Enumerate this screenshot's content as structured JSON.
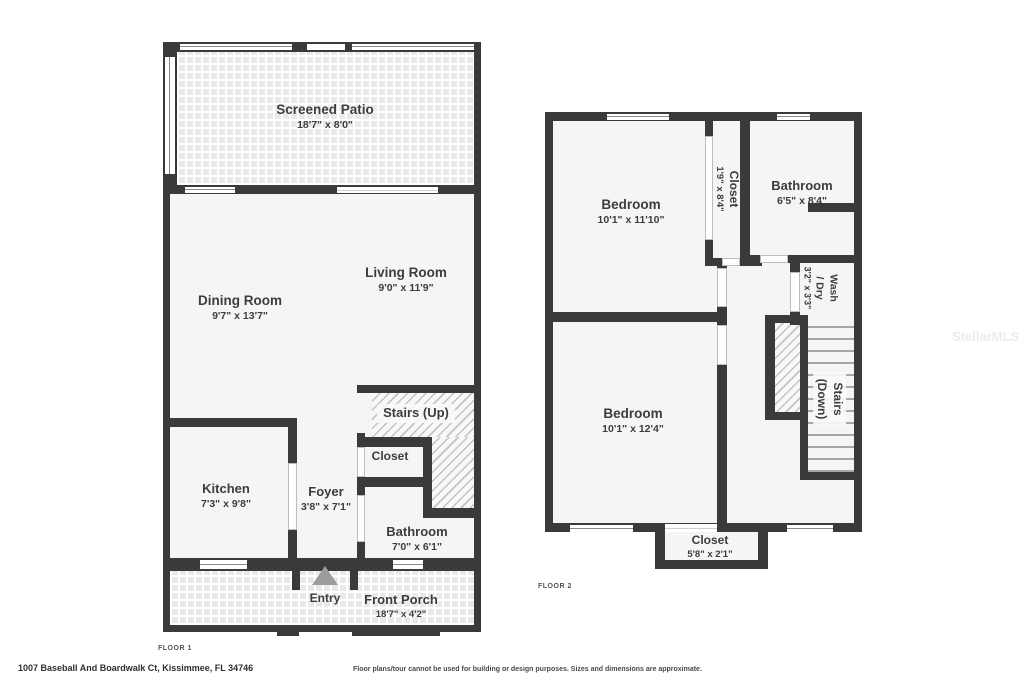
{
  "colors": {
    "wall": "#3a3a3a",
    "room_fill": "#f5f5f5",
    "tile_fill": "#e9e9e9",
    "text": "#3d3d3d",
    "entry_arrow": "#9c9c9c"
  },
  "watermark": "StellarMLS",
  "floor1": {
    "label": "FLOOR 1",
    "screened_patio": {
      "name": "Screened Patio",
      "dims": "18'7\" x 8'0\""
    },
    "dining_room": {
      "name": "Dining Room",
      "dims": "9'7\" x 13'7\""
    },
    "living_room": {
      "name": "Living Room",
      "dims": "9'0\" x 11'9\""
    },
    "stairs_up": {
      "name": "Stairs (Up)"
    },
    "closet": {
      "name": "Closet"
    },
    "kitchen": {
      "name": "Kitchen",
      "dims": "7'3\" x 9'8\""
    },
    "foyer": {
      "name": "Foyer",
      "dims": "3'8\" x 7'1\""
    },
    "bathroom": {
      "name": "Bathroom",
      "dims": "7'0\" x 6'1\""
    },
    "entry": {
      "name": "Entry"
    },
    "front_porch": {
      "name": "Front Porch",
      "dims": "18'7\" x 4'2\""
    }
  },
  "floor2": {
    "label": "FLOOR 2",
    "bedroom_top": {
      "name": "Bedroom",
      "dims": "10'1\" x 11'10\""
    },
    "closet_hall": {
      "name": "Closet",
      "dims": "1'9\" x 8'4\""
    },
    "bathroom": {
      "name": "Bathroom",
      "dims": "6'5\" x 8'4\""
    },
    "wash_dry": {
      "line1": "Wash",
      "line2": "/ Dry",
      "dims": "3'2\" x 3'3\""
    },
    "stairs_down": {
      "line1": "Stairs",
      "line2": "(Down)"
    },
    "bedroom_bottom": {
      "name": "Bedroom",
      "dims": "10'1\" x 12'4\""
    },
    "closet_bottom": {
      "name": "Closet",
      "dims": "5'8\" x 2'1\""
    }
  },
  "footer": {
    "address": "1007 Baseball And Boardwalk Ct, Kissimmee, FL 34746",
    "disclaimer": "Floor plans/tour cannot be used for building or design purposes. Sizes and dimensions are approximate."
  }
}
